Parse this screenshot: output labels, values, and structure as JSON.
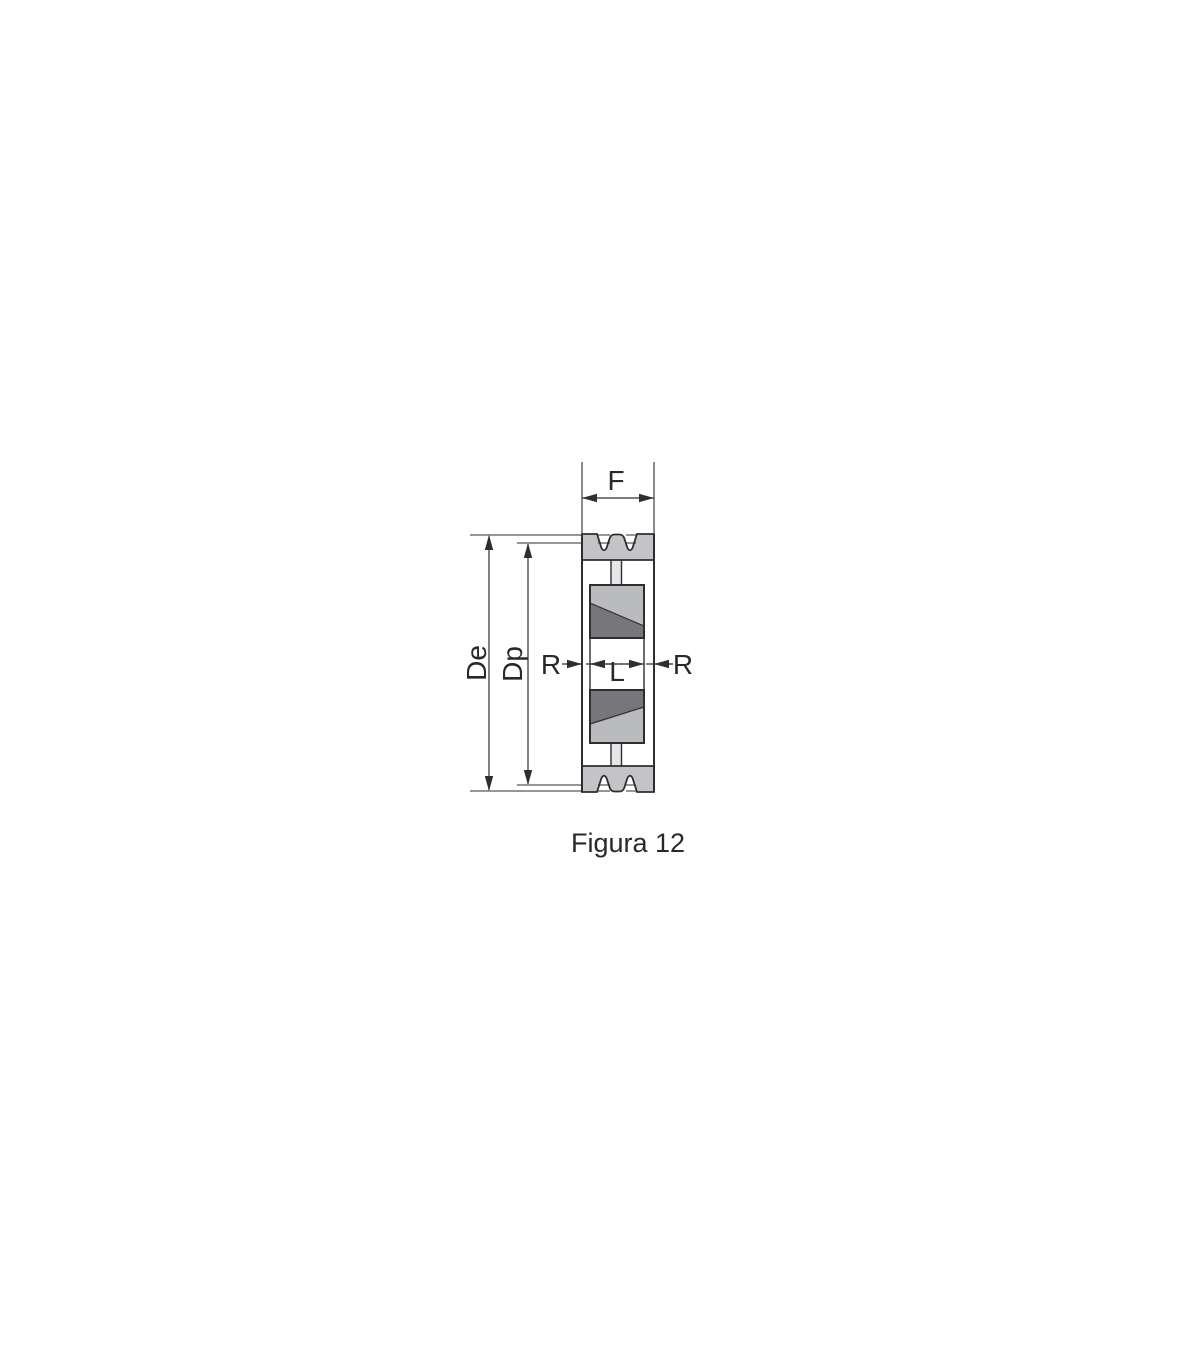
{
  "figure": {
    "caption": "Figura 12",
    "labels": {
      "width": "F",
      "outer_diameter": "De",
      "pitch_diameter": "Dp",
      "recess": "R",
      "hub_length": "L"
    }
  },
  "colors": {
    "line": "#2e2e30",
    "text": "#29292b",
    "rim_gray": "#c3c4c7",
    "hub_gray": "#babbbe",
    "bushing_dark_gray": "#76777b",
    "stem_gray": "#e6e6e8",
    "background": "#ffffff"
  }
}
